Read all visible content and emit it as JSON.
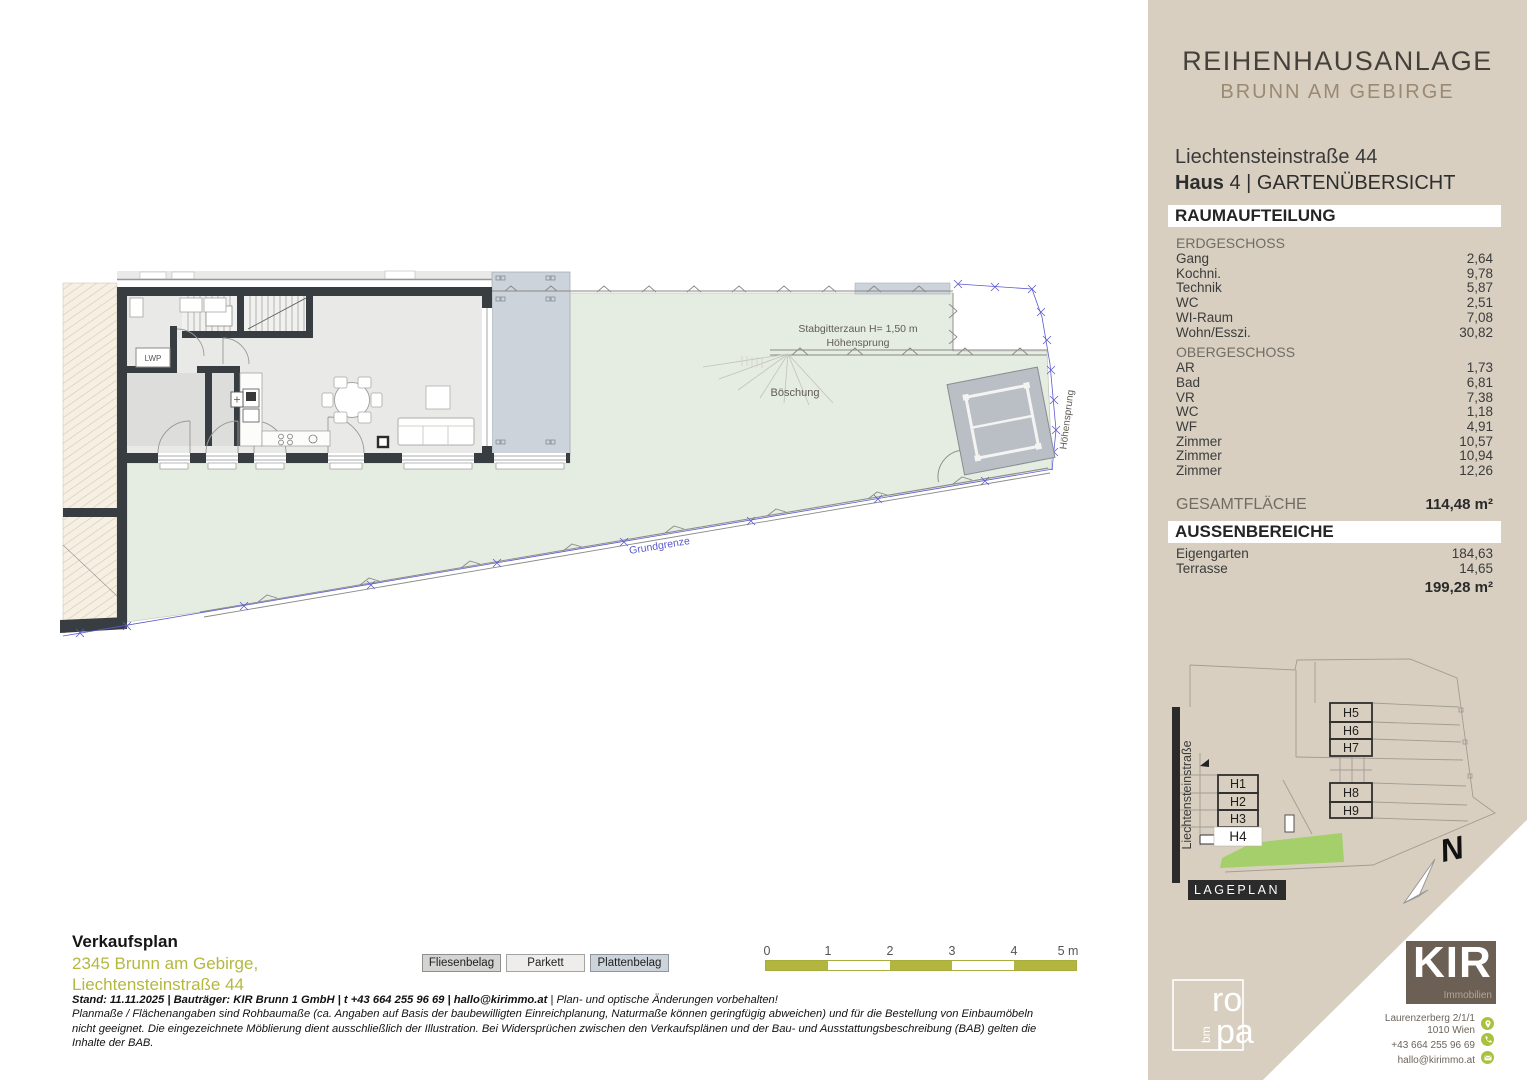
{
  "sidebar": {
    "title": "REIHENHAUSANLAGE",
    "subtitle": "BRUNN AM GEBIRGE",
    "address": "Liechtensteinstraße 44",
    "unit_label": "Haus",
    "unit_rest": " 4 | GARTENÜBERSICHT"
  },
  "raumaufteilung": {
    "heading": "RAUMAUFTEILUNG",
    "sections": [
      {
        "label": "ERDGESCHOSS",
        "rows": [
          {
            "name": "Gang",
            "value": "2,64"
          },
          {
            "name": "Kochni.",
            "value": "9,78"
          },
          {
            "name": "Technik",
            "value": "5,87"
          },
          {
            "name": "WC",
            "value": "2,51"
          },
          {
            "name": "WI-Raum",
            "value": "7,08"
          },
          {
            "name": "Wohn/Esszi.",
            "value": "30,82"
          }
        ]
      },
      {
        "label": "OBERGESCHOSS",
        "rows": [
          {
            "name": "AR",
            "value": "1,73"
          },
          {
            "name": "Bad",
            "value": "6,81"
          },
          {
            "name": "VR",
            "value": "7,38"
          },
          {
            "name": "WC",
            "value": "1,18"
          },
          {
            "name": "WF",
            "value": "4,91"
          },
          {
            "name": "Zimmer",
            "value": "10,57"
          },
          {
            "name": "Zimmer",
            "value": "10,94"
          },
          {
            "name": "Zimmer",
            "value": "12,26"
          }
        ]
      }
    ],
    "total_label": "GESAMTFLÄCHE",
    "total_value": "114,48 m²"
  },
  "aussenbereiche": {
    "heading": "AUSSENBEREICHE",
    "rows": [
      {
        "name": "Eigengarten",
        "value": "184,63"
      },
      {
        "name": "Terrasse",
        "value": "14,65"
      }
    ],
    "total_value": "199,28 m²"
  },
  "lageplan": {
    "caption": "LAGEPLAN",
    "street": "Liechtensteinstraße",
    "houses": [
      "H1",
      "H2",
      "H3",
      "H4",
      "H5",
      "H6",
      "H7",
      "H8",
      "H9"
    ],
    "highlight_house": "H4",
    "north_letter": "N"
  },
  "plan_labels": {
    "fence": "Stabgitterzaun H= 1,50 m",
    "hoehensprung_top": "Höhensprung",
    "hoehensprung_right": "Höhensprung",
    "boeschung": "Böschung",
    "grundgrenze": "Grundgrenze",
    "lwp": "LWP"
  },
  "legend": {
    "items": [
      {
        "label": "Fliesenbelag",
        "color": "#d4d4d2"
      },
      {
        "label": "Parkett",
        "color": "#eeedeb"
      },
      {
        "label": "Plattenbelag",
        "color": "#ccd3db"
      }
    ]
  },
  "scalebar": {
    "ticks": [
      "0",
      "1",
      "2",
      "3",
      "4",
      "5 m"
    ]
  },
  "footer": {
    "title": "Verkaufsplan",
    "address_line1": "2345 Brunn am Gebirge,",
    "address_line2": "Liechtensteinstraße 44",
    "note_bold": "Stand: 11.11.2025 | Bauträger: KIR Brunn 1 GmbH | t +43 664 255 96 69 | hallo@kirimmo.at",
    "note_tail": "  | Plan- und optische Änderungen vorbehalten!",
    "note_lines": [
      "Planmaße / Flächenangaben sind Rohbaumaße (ca. Angaben auf Basis der baubewilligten Einreichplanung, Naturmaße können geringfügig abweichen) und für die Bestellung von Einbaumöbeln",
      "nicht geeignet. Die eingezeichnete Möblierung dient ausschließlich der Illustration. Bei Widersprüchen zwischen den Verkaufsplänen und der Bau- und Ausstattungsbeschreibung (BAB) gelten die",
      "Inhalte der BAB."
    ]
  },
  "kir": {
    "brand": "KIR",
    "brand_sub": "Immobilien",
    "address1": "Laurenzerberg 2/1/1",
    "address2": "1010 Wien",
    "phone": "+43 664 255 96 69",
    "email": "hallo@kirimmo.at"
  },
  "ropa": {
    "line1": "ro",
    "line2": "pa",
    "side": "bm"
  },
  "colors": {
    "sidebar_beige": "#d8cfc1",
    "accent_olive": "#b2b63f",
    "lageplan_green": "#a5cf6a",
    "garden_green": "#e5ece1",
    "terrace_gray": "#ccd3da",
    "wall_dark": "#383d41",
    "boundary_blue": "#5b5bd0",
    "kir_brown": "#6c5f53",
    "contact_icon_green": "#a9c23d"
  }
}
